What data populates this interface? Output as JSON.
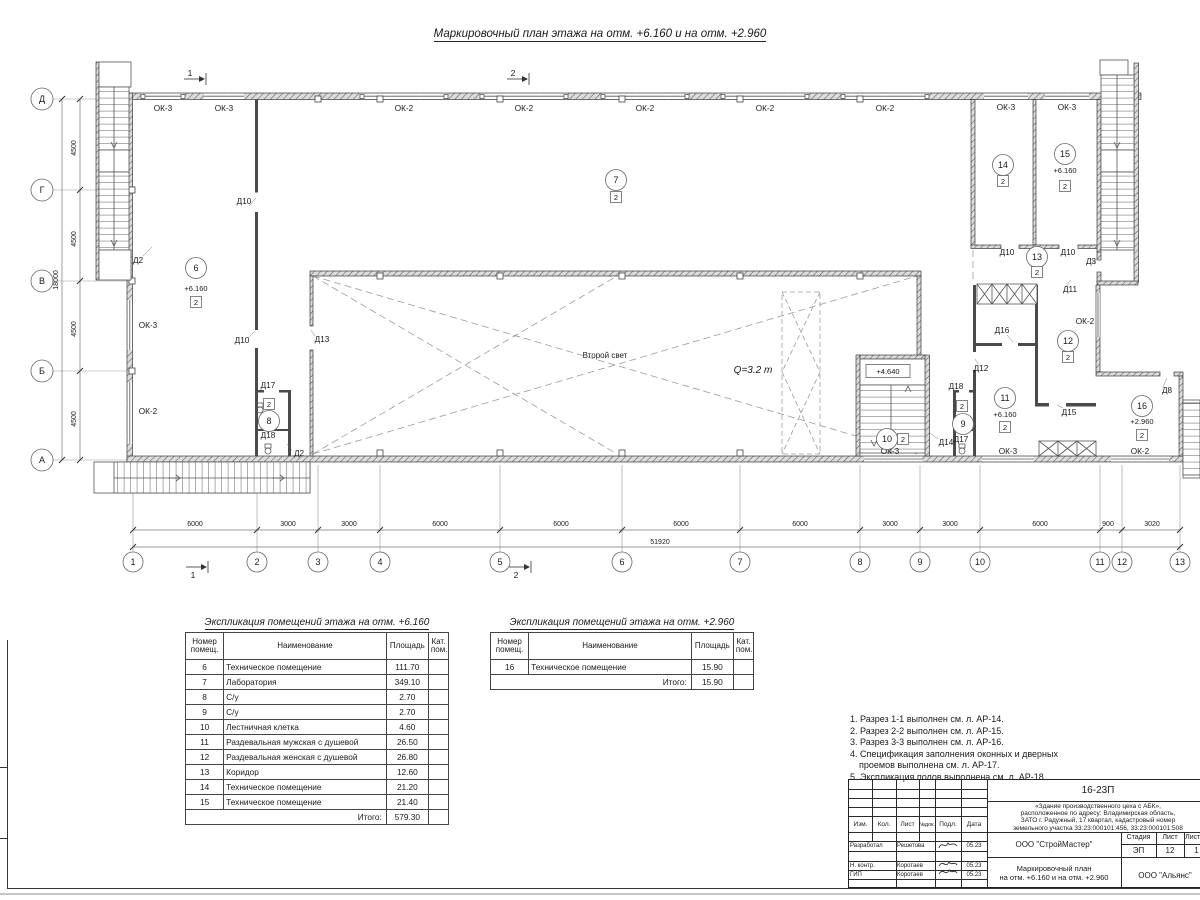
{
  "page": {
    "title": "Маркировочный план этажа на отм. +6.160 и на отм. +2.960"
  },
  "plan": {
    "windows": [
      "ОК-3",
      "ОК-3",
      "ОК-2",
      "ОК-2",
      "ОК-2",
      "ОК-2",
      "ОК-2",
      "ОК-3",
      "ОК-3",
      "ОК-3",
      "ОК-2",
      "ОК-3",
      "ОК-3",
      "ОК-2",
      "ОК-2"
    ],
    "doors": [
      "Д2",
      "Д10",
      "Д10",
      "Д13",
      "Д17",
      "Д18",
      "Д2",
      "Д10",
      "Д10",
      "Д3",
      "Д11",
      "Д16",
      "Д12",
      "Д18",
      "Д17",
      "Д15",
      "Д14",
      "Д8"
    ],
    "rooms": [
      {
        "num": "6",
        "elev": "+6.160",
        "badge": "2"
      },
      {
        "num": "7",
        "badge": "2"
      },
      {
        "num": "8",
        "badge": "2"
      },
      {
        "num": "9",
        "badge": "2"
      },
      {
        "num": "10",
        "badge": "2"
      },
      {
        "num": "11",
        "elev": "+6.160",
        "badge": "2"
      },
      {
        "num": "12",
        "badge": "2"
      },
      {
        "num": "13",
        "badge": "2"
      },
      {
        "num": "14",
        "badge": "2"
      },
      {
        "num": "15",
        "elev": "+6.160",
        "badge": "2"
      },
      {
        "num": "16",
        "elev": "+2.960",
        "badge": "2"
      }
    ],
    "stair_elev": "+4.640",
    "second_light": "Второй свет",
    "crane_load": "Q=3.2 т",
    "section1": "1",
    "section2": "2",
    "axes_rows": [
      "Д",
      "Г",
      "В",
      "Б",
      "А"
    ],
    "axes_cols": [
      "1",
      "2",
      "3",
      "4",
      "5",
      "6",
      "7",
      "8",
      "9",
      "10",
      "11",
      "12",
      "13"
    ],
    "dims_bottom": [
      "6000",
      "3000",
      "3000",
      "6000",
      "6000",
      "6000",
      "6000",
      "3000",
      "3000",
      "6000",
      "900",
      "3020"
    ],
    "dim_total": "51920",
    "dims_left": [
      "4500",
      "4500",
      "4500",
      "4500"
    ],
    "dim_left_total": "18000"
  },
  "table1": {
    "title": "Экспликация помещений этажа на отм. +6.160",
    "headers": {
      "num": "Номер помещ.",
      "name": "Наименование",
      "area": "Площадь",
      "cat": "Кат. пом."
    },
    "rows": [
      {
        "num": "6",
        "name": "Техническое помещение",
        "area": "111.70"
      },
      {
        "num": "7",
        "name": "Лаборатория",
        "area": "349.10"
      },
      {
        "num": "8",
        "name": "С/у",
        "area": "2.70"
      },
      {
        "num": "9",
        "name": "С/у",
        "area": "2.70"
      },
      {
        "num": "10",
        "name": "Лестничная клетка",
        "area": "4.60"
      },
      {
        "num": "11",
        "name": "Раздевальная мужская с душевой",
        "area": "26.50"
      },
      {
        "num": "12",
        "name": "Раздевальная женская с душевой",
        "area": "26.80"
      },
      {
        "num": "13",
        "name": "Коридор",
        "area": "12.60"
      },
      {
        "num": "14",
        "name": "Техническое помещение",
        "area": "21.20"
      },
      {
        "num": "15",
        "name": "Техническое помещение",
        "area": "21.40"
      }
    ],
    "total_label": "Итого:",
    "total": "579.30"
  },
  "table2": {
    "title": "Экспликация помещений этажа на отм. +2.960",
    "headers": {
      "num": "Номер помещ.",
      "name": "Наименование",
      "area": "Площадь",
      "cat": "Кат. пом."
    },
    "rows": [
      {
        "num": "16",
        "name": "Техническое помещение",
        "area": "15.90"
      }
    ],
    "total_label": "Итого:",
    "total": "15.90"
  },
  "notes": [
    "1. Разрез 1-1 выполнен см. л. АР-14.",
    "2. Разрез 2-2 выполнен см. л. АР-15.",
    "3. Разрез 3-3 выполнен см. л. АР-16.",
    "4. Спецификация заполнения оконных и дверных",
    "проемов выполнена см. л. АР-17.",
    "5. Экспликация полов выполнена см. л. АР-18."
  ],
  "titleblock": {
    "doc_code": "16-23П",
    "project_lines": [
      "«Здание производственного цеха с АБК»,",
      "расположенное по адресу: Владимирская область,",
      "ЗАТО г. Радужный, 17 квартал, кадастровый номер",
      "земельного участка 33:23:000101:456, 33:23:000101:508"
    ],
    "cols": {
      "izm": "Изм.",
      "kol": "Кол.",
      "list": "Лист",
      "ndok": "№док.",
      "podp": "Подл.",
      "date": "Дата"
    },
    "roles": [
      {
        "role": "Разработал",
        "name": "Решетова",
        "date": "05.23"
      },
      {
        "role": "Н. контр.",
        "name": "Коротаев",
        "date": "05.23"
      },
      {
        "role": "ГИП",
        "name": "Коротаев",
        "date": "05.23"
      }
    ],
    "org1": "ООО \"СтройМастер\"",
    "stage_label": "Стадия",
    "sheet_label": "Лист",
    "sheets_label": "Листов",
    "stage": "ЭП",
    "sheet": "12",
    "sheets": "1",
    "title_lines": [
      "Маркировочный план",
      "на отм. +6.160 и на отм. +2.960"
    ],
    "org2": "ООО \"Альянс\""
  }
}
